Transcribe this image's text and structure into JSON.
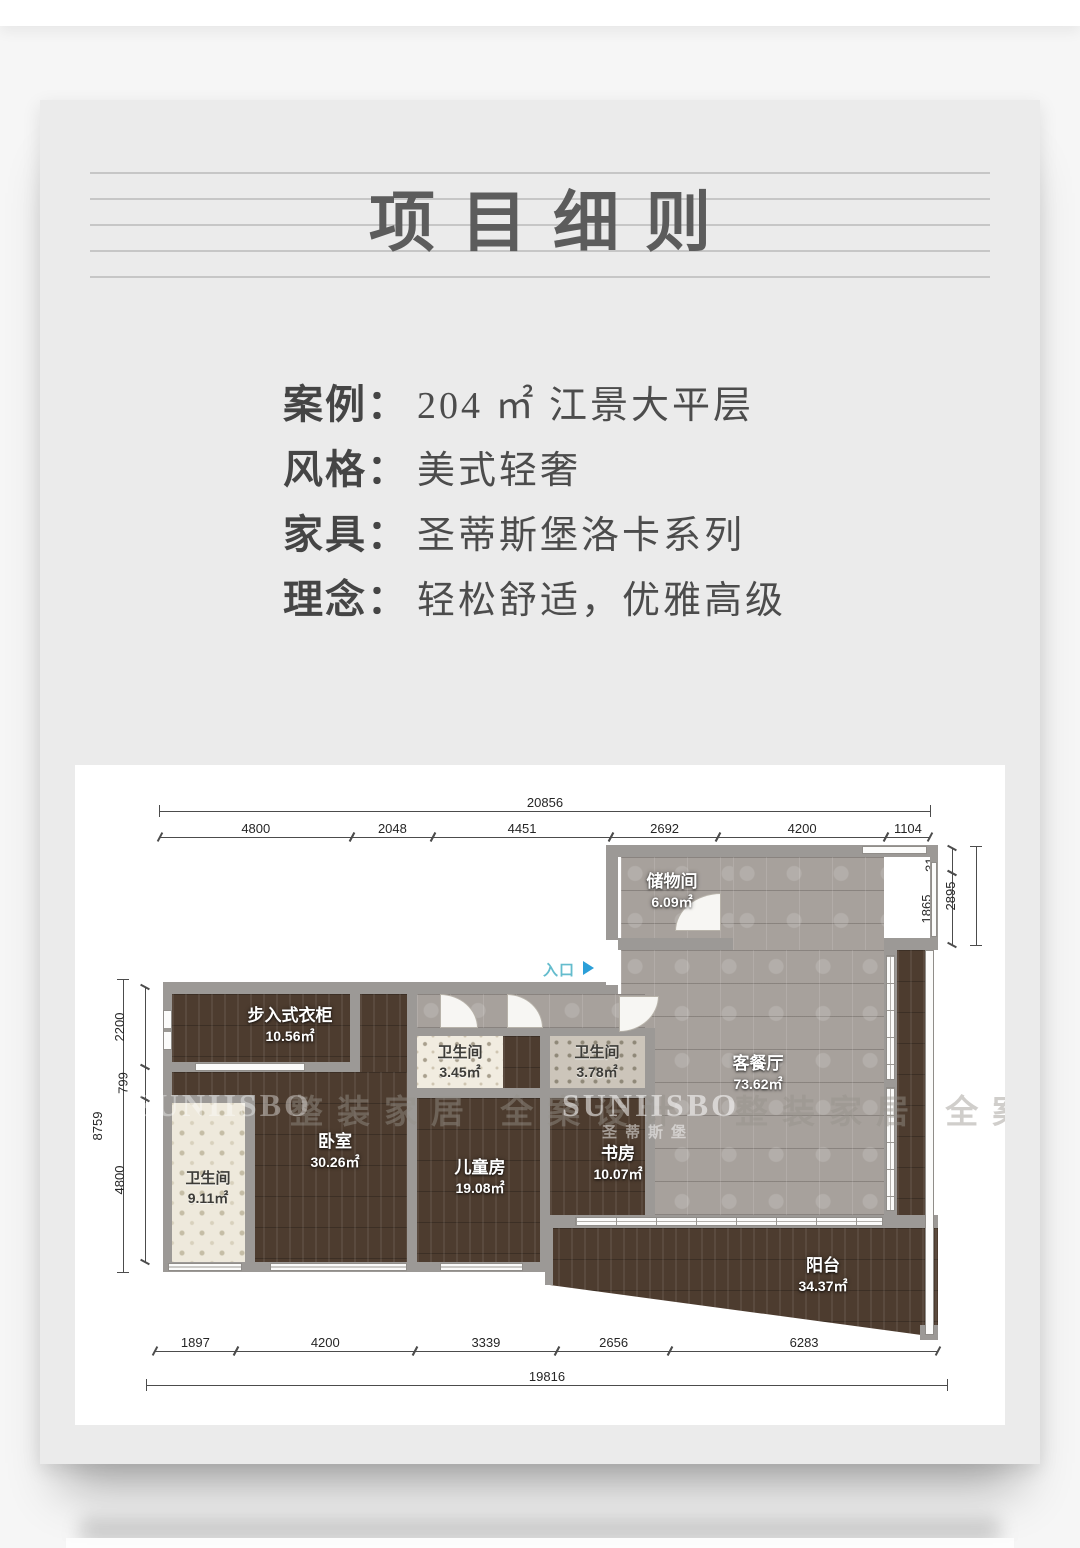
{
  "page": {
    "title": "项目细则"
  },
  "info": {
    "rows": [
      {
        "label": "案例：",
        "value": "204 ㎡ 江景大平层"
      },
      {
        "label": "风格：",
        "value": "美式轻奢"
      },
      {
        "label": "家具：",
        "value": "圣蒂斯堡洛卡系列"
      },
      {
        "label": "理念：",
        "value": "轻松舒适，优雅高级"
      }
    ]
  },
  "floorplan": {
    "entrance_label": "入口",
    "rooms": [
      {
        "name": "储物间",
        "area": "6.09㎡"
      },
      {
        "name": "客餐厅",
        "area": "73.62㎡"
      },
      {
        "name": "步入式衣柜",
        "area": "10.56㎡"
      },
      {
        "name": "卫生间",
        "area": "3.45㎡"
      },
      {
        "name": "卫生间",
        "area": "3.78㎡"
      },
      {
        "name": "卧室",
        "area": "30.26㎡"
      },
      {
        "name": "儿童房",
        "area": "19.08㎡"
      },
      {
        "name": "书房",
        "area": "10.07㎡"
      },
      {
        "name": "卫生间",
        "area": "9.11㎡"
      },
      {
        "name": "阳台",
        "area": "34.37㎡"
      }
    ],
    "dims": {
      "top_total": "20856",
      "top_segments": [
        "4800",
        "2048",
        "4451",
        "2692",
        "4200",
        "1104"
      ],
      "left_total": "8759",
      "left_segments": [
        "2200",
        "799",
        "4800"
      ],
      "right_segments": [
        "310",
        "1865"
      ],
      "right_outer": "2895",
      "bottom_segments": [
        "1897",
        "4200",
        "3339",
        "2656",
        "6283"
      ],
      "bottom_total": "19816"
    },
    "watermarks": {
      "brand": "SUNIISBO",
      "brand_cn": "圣蒂斯堡",
      "slogan": "整装家居 全案设计"
    }
  },
  "colors": {
    "card_bg": "#ebebeb",
    "wood": "#4d3c2f",
    "tile_gray": "#a7a19c",
    "wall": "#9c9996",
    "entry_text": "#64bccd",
    "entry_arrow": "#2b9fd8",
    "title_text": "#5c5c5c"
  }
}
